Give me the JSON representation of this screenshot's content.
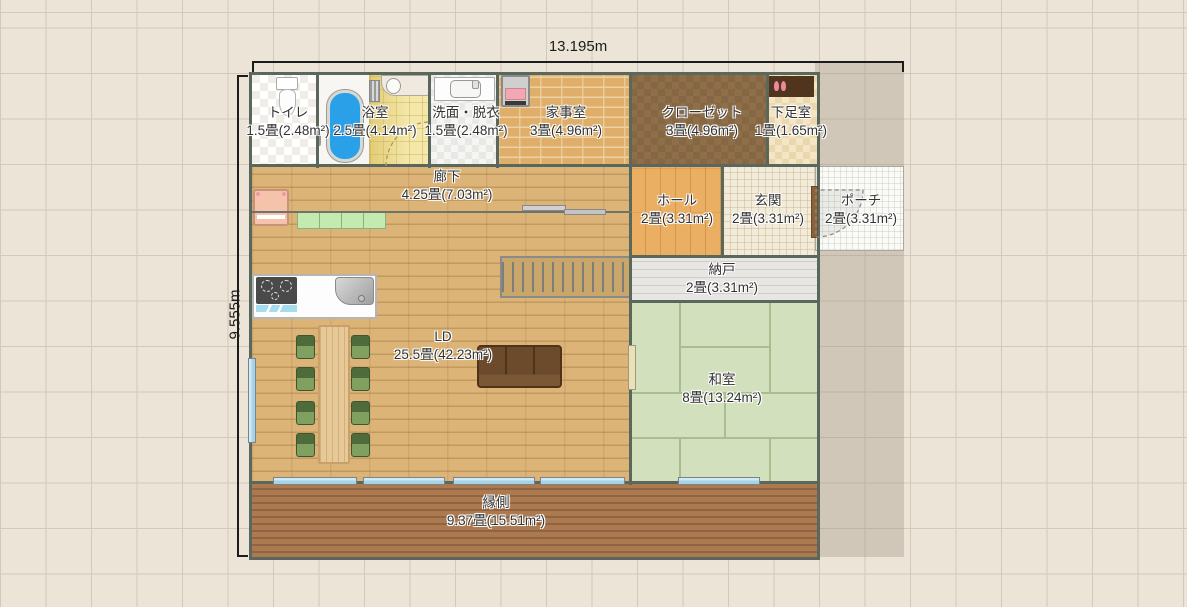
{
  "dimensions": {
    "width_label": "13.195m",
    "height_label": "9.555m"
  },
  "rooms": {
    "toilet": {
      "name": "トイレ",
      "size": "1.5畳(2.48m²)"
    },
    "bathroom": {
      "name": "浴室",
      "size": "2.5畳(4.14m²)"
    },
    "washroom": {
      "name": "洗面・脱衣",
      "size": "1.5畳(2.48m²)"
    },
    "utility_room": {
      "name": "家事室",
      "size": "3畳(4.96m²)"
    },
    "closet": {
      "name": "クローゼット",
      "size": "3畳(4.96m²)"
    },
    "shoe_room": {
      "name": "下足室",
      "size": "1畳(1.65m²)"
    },
    "hallway": {
      "name": "廊下",
      "size": "4.25畳(7.03m²)"
    },
    "hall": {
      "name": "ホール",
      "size": "2畳(3.31m²)"
    },
    "entrance": {
      "name": "玄関",
      "size": "2畳(3.31m²)"
    },
    "porch": {
      "name": "ポーチ",
      "size": "2畳(3.31m²)"
    },
    "storage_room": {
      "name": "納戸",
      "size": "2畳(3.31m²)"
    },
    "living_dining": {
      "name": "LD",
      "size": "25.5畳(42.23m²)"
    },
    "japanese_room": {
      "name": "和室",
      "size": "8畳(13.24m²)"
    },
    "veranda": {
      "name": "縁側",
      "size": "9.37畳(15.51m²)"
    }
  },
  "fixtures": {
    "toilet_icon": "toilet bowl with tank",
    "bathtub_icon": "blue oval bathtub",
    "bath_counter_icon": "bath washing counter with basin",
    "washbasin_icon": "vanity basin counter",
    "washing_machine_icon": "washing machine",
    "shoe_shelf_icon": "shoe shelf with slippers",
    "refrigerator_icon": "refrigerator",
    "kitchen_cabinet_icon": "green kitchen cabinets",
    "stove_icon": "3-burner gas stove",
    "sink_icon": "kitchen sink",
    "dining_table": "wooden dining table",
    "chairs": "8 green chairs",
    "sofa": "brown 3-seat sofa",
    "stairs": "straight staircase",
    "sliding_door": "grey sliding door",
    "entrance_door": "hinged door with swing arc",
    "windows": "light blue sliding windows"
  },
  "colors": {
    "background": "#ece4d7",
    "grid_line": "#d2c9bb",
    "wall": "#5a675c",
    "wood_floor": "#dcb478",
    "tatami": "#d3e0bd",
    "veranda_deck": "#ab7a4e",
    "window_glass": "#a5d3e8",
    "bathtub_blue": "#2aa0e8",
    "closet_brown": "#8f6f4a",
    "hall_orange": "#eaaf63",
    "site_shade": "#d6cec1"
  }
}
